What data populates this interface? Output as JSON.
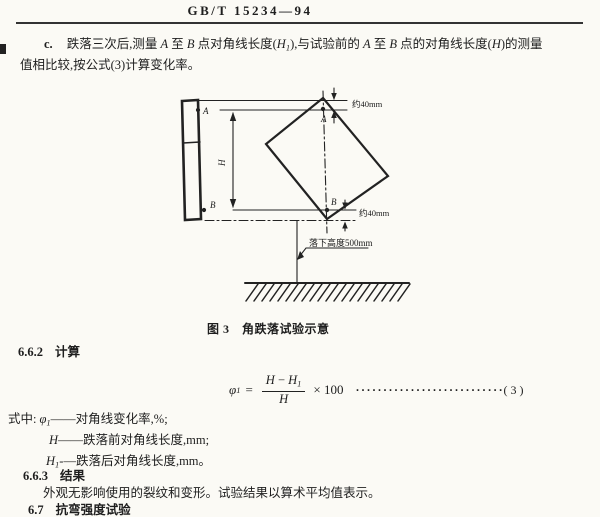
{
  "header": {
    "standard_number": "GB/T 15234—94"
  },
  "para_c": {
    "label": "c.",
    "l1": {
      "s1": "跌落三次后,测量 ",
      "v1": "A",
      "s2": " 至 ",
      "v2": "B",
      "s3": " 点对角线长度(",
      "v3": "H",
      "v3sub": "1",
      "s4": "),与试验前的 ",
      "v4": "A",
      "s5": " 至 ",
      "v5": "B",
      "s6": " 点的对角线长度(",
      "v6": "H",
      "s7": ")的测量"
    },
    "line2": "值相比较,按公式(3)计算变化率。"
  },
  "diagram": {
    "point_a_side": "A",
    "point_b_side": "B",
    "point_a": "A",
    "point_b": "B",
    "dim_h": "H",
    "gap_top": "约40mm",
    "gap_bottom": "约40mm",
    "drop_height": "落下高度500mm",
    "caption": "图 3　角跌落试验示意"
  },
  "sections": {
    "calc": {
      "num": "6.6.2",
      "title": "计算"
    },
    "result": {
      "num": "6.6.3",
      "title": "结果"
    },
    "next": {
      "num": "6.7",
      "title": "抗弯强度试验"
    }
  },
  "formula": {
    "lhs": "φ",
    "lhs_sub": "1",
    "equals": "=",
    "num_var1": "H",
    "minus": " − ",
    "num_var2": "H",
    "num_var2_sub": "1",
    "den": "H",
    "times": "× 100",
    "dots": "········································",
    "eq_no": "( 3 )"
  },
  "where": {
    "intro": "式中:",
    "line1": {
      "sym": "φ",
      "sub": "1",
      "dash": "——",
      "desc": "对角线变化率,%;"
    },
    "line2": {
      "sym": "H",
      "dash": "——",
      "desc": "跌落前对角线长度,mm;"
    },
    "line3": {
      "sym": "H",
      "sub": "1",
      "dash": "-—",
      "desc": "跌落后对角线长度,mm。"
    }
  },
  "result_text": "外观无影响使用的裂纹和变形。试验结果以算术平均值表示。"
}
